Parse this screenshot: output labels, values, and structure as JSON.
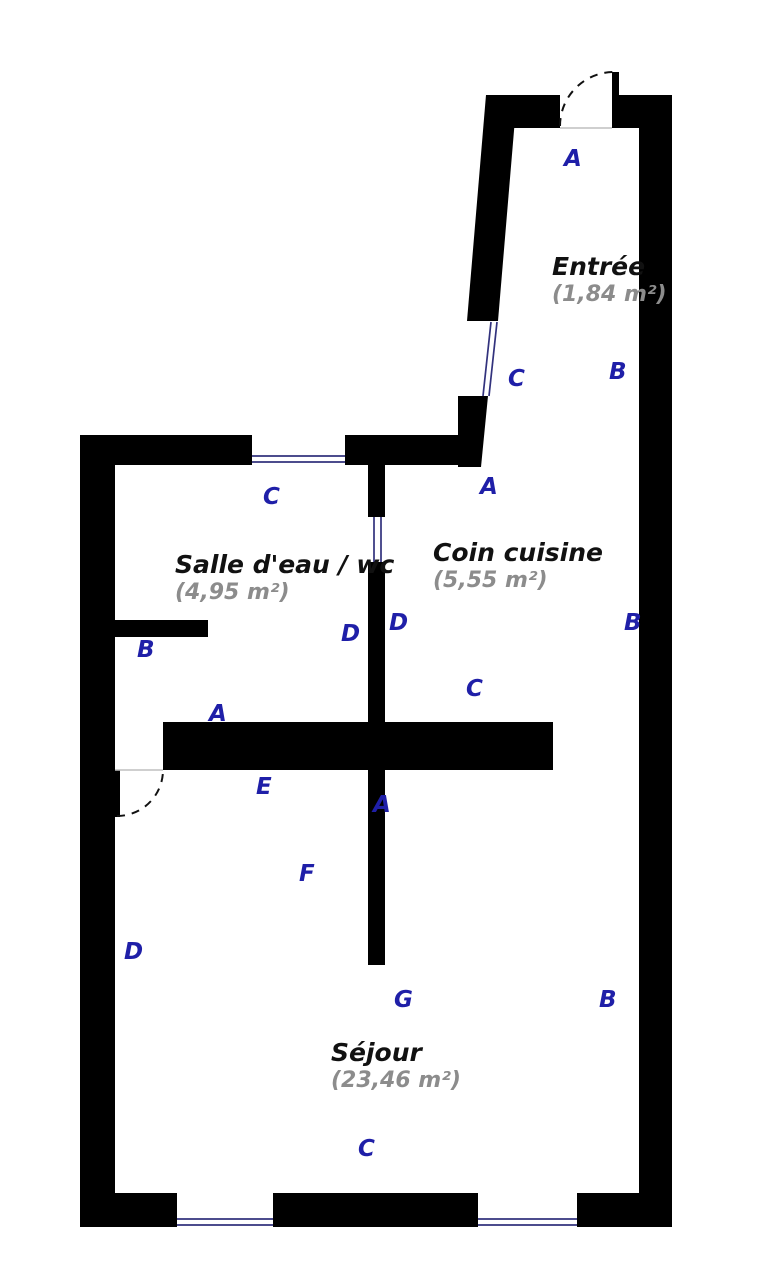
{
  "plan": {
    "type": "floor-plan",
    "colors": {
      "wall": "#000000",
      "segment_label": "#1f1fa8",
      "room_name": "#111111",
      "room_area": "#8c8c8c",
      "window_line": "#32327d"
    },
    "rooms": [
      {
        "name": "Entrée",
        "area": "(1,84 m²)"
      },
      {
        "name": "Salle d'eau / wc",
        "area": "(4,95 m²)"
      },
      {
        "name": "Coin cuisine",
        "area": "(5,55 m²)"
      },
      {
        "name": "Séjour",
        "area": "(23,46 m²)"
      }
    ],
    "segment_labels": [
      {
        "text": "A"
      },
      {
        "text": "B"
      },
      {
        "text": "C"
      },
      {
        "text": "A"
      },
      {
        "text": "C"
      },
      {
        "text": "D"
      },
      {
        "text": "B"
      },
      {
        "text": "D"
      },
      {
        "text": "B"
      },
      {
        "text": "C"
      },
      {
        "text": "A"
      },
      {
        "text": "E"
      },
      {
        "text": "A"
      },
      {
        "text": "F"
      },
      {
        "text": "D"
      },
      {
        "text": "G"
      },
      {
        "text": "B"
      },
      {
        "text": "C"
      }
    ]
  }
}
